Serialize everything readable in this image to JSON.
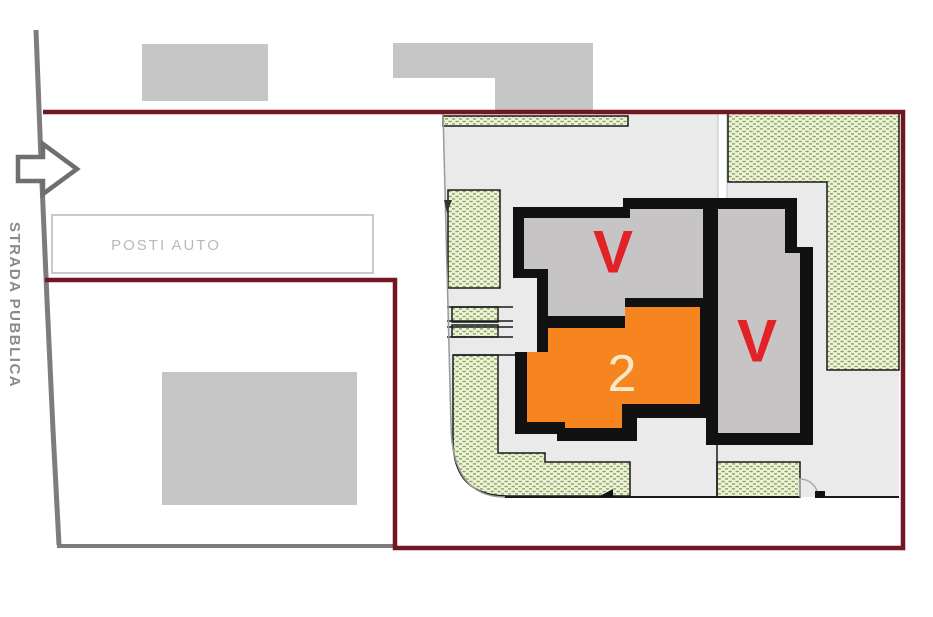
{
  "plan": {
    "labels": {
      "road": "STRADA PUBBLICA",
      "parking": "POSTI AUTO",
      "unit_left_status": "V",
      "unit_right_status": "V",
      "unit_number": "2"
    },
    "colors": {
      "boundary_red": "#701722",
      "road_gray": "#7d7d7d",
      "neighbor_building_gray": "#c6c6c6",
      "site_gray": "#eaeaea",
      "wall_black": "#111111",
      "unit_gray": "#c6c4c5",
      "unit_orange": "#f6851f",
      "status_red": "#e32228",
      "unit_number_cream": "#f7e8c6",
      "green_fill": "#edf2da",
      "green_hatch": "#8aa258",
      "parking_border_gray": "#c9c9c9",
      "parking_text_gray": "#b9b9b9",
      "road_text_gray": "#8a8a8a",
      "arrow_gray": "#6f6f6f"
    }
  }
}
